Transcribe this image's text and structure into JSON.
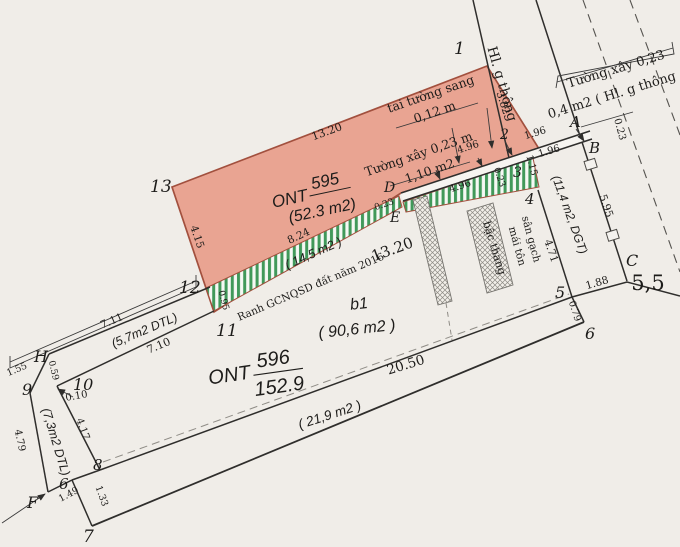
{
  "points": {
    "n1": "1",
    "n2": "2",
    "n3": "3",
    "n4": "4",
    "n5": "5",
    "n6r": "6",
    "n7": "7",
    "n8": "8",
    "n6l": "6",
    "n9": "9",
    "n10": "10",
    "n11": "11",
    "n12": "12",
    "n13": "13",
    "A": "A",
    "B": "B",
    "C": "C",
    "D": "D",
    "E": "E",
    "F": "F",
    "H": "H"
  },
  "parcels": {
    "p595_name": "ONT",
    "p595_num": "595",
    "p595_area": "(52.3 m2)",
    "p596_name": "ONT",
    "p596_num": "596",
    "p596_area": "152.9",
    "b1": "b1",
    "b1_area": "( 90,6 m2 )"
  },
  "dims": {
    "d1320top": "13.20",
    "d382": "3.82",
    "d415": "4.15",
    "d824": "8.24",
    "d095": "0.95",
    "d1320big": "13.20",
    "d023de": "0.23",
    "d496a": "4.96",
    "d496b": "4.96",
    "d023w": "0.23",
    "d196a": "1.96",
    "d196b": "1.96",
    "d115": "1.15",
    "d023a": "0.23",
    "d595": "5.95",
    "d471": "4.71",
    "d188": "1.88",
    "d55": "5,5",
    "d079": "0.79",
    "d2050": "20.50",
    "d711": "7.11",
    "d710": "7.10",
    "d155": "1.55",
    "d059": "0.59",
    "d010": "0.10",
    "d479": "4.79",
    "d417": "4.17",
    "d149": "1.49",
    "d133": "1.33"
  },
  "labels": {
    "hl_thong": "Hl. g thông",
    "tuong_top": "Tường xây 0,23",
    "tuong_top2": "0,4 m2 ( Hl. g thông",
    "tai_tuong": "tai tường sang",
    "d012": "0,12 m",
    "tuong_xay": "Tường xây 0,23 m",
    "d110": "1,10 m2",
    "ranh": "Ranh GCNQSD đất năm 2016",
    "strip14": "( 14,5 m2 )",
    "dgt": "(11,4 m2, DGT)",
    "dtl57": "(5,7m2 DTL)",
    "dtl73": "(7,3m2 DTL)",
    "strip219": "( 21,9 m2 )",
    "san_gach": "sân gạch",
    "mai_ton": "mái tôn",
    "bac_thang": "bậc thang"
  },
  "colors": {
    "parcel_fill": "#e9a492",
    "parcel_border": "#a2503e",
    "hatch_green": "#41995a",
    "paper": "#f0ede8",
    "line": "#2f2e2c"
  }
}
